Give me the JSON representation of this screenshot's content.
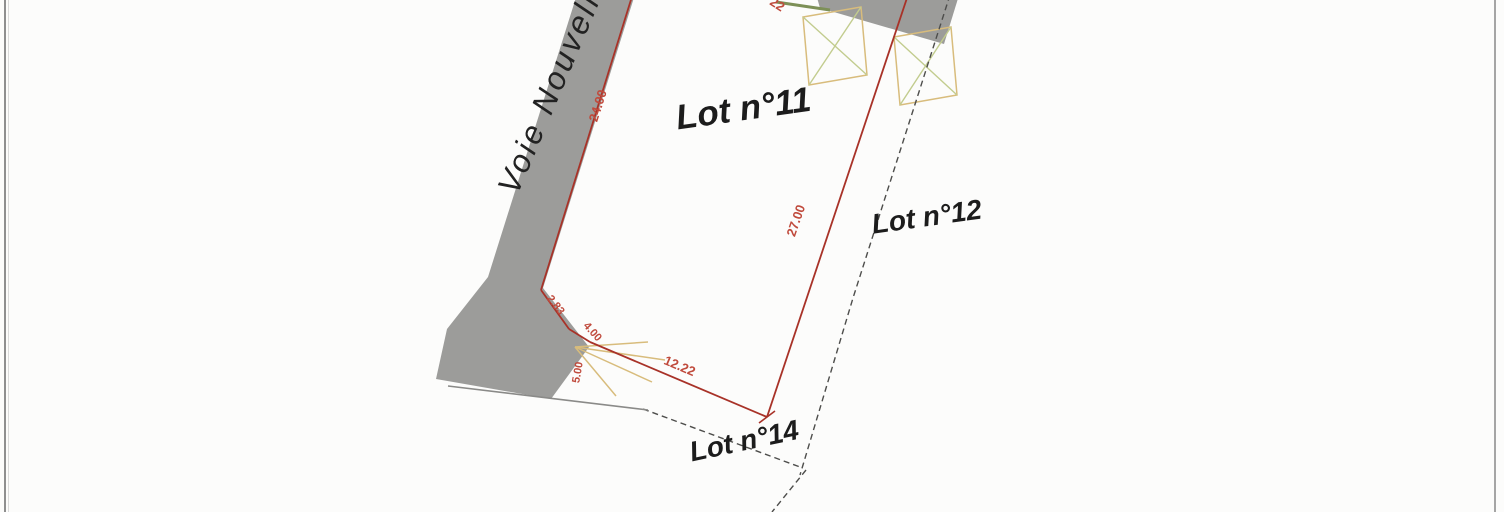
{
  "plan": {
    "street_label": "Voie Nouvelle",
    "lots": {
      "lot11": {
        "label": "Lot n°11"
      },
      "lot12": {
        "label": "Lot n°12"
      },
      "lot14": {
        "label": "Lot n°14"
      }
    },
    "dimensions": {
      "left_edge": "24.00",
      "right_edge": "27.00",
      "bottom_edge": "12.22",
      "chamfer": "2.83",
      "access_a": "4.00",
      "access_b": "5.00",
      "top_partial": "22"
    },
    "colors": {
      "boundary_red": "#a83228",
      "dimension_red": "#c04a3c",
      "road_gray": "#9c9c9a",
      "hatch_yellow": "#d8bc7c",
      "hatch_green": "#c2cc8e",
      "dashed_gray": "#4d4d4b",
      "street_text": "#222222",
      "lot_text": "#1c1c1c",
      "frame_gray": "#8f8f8f",
      "green_edge": "#7d9057",
      "background": "#fcfcfb"
    }
  }
}
